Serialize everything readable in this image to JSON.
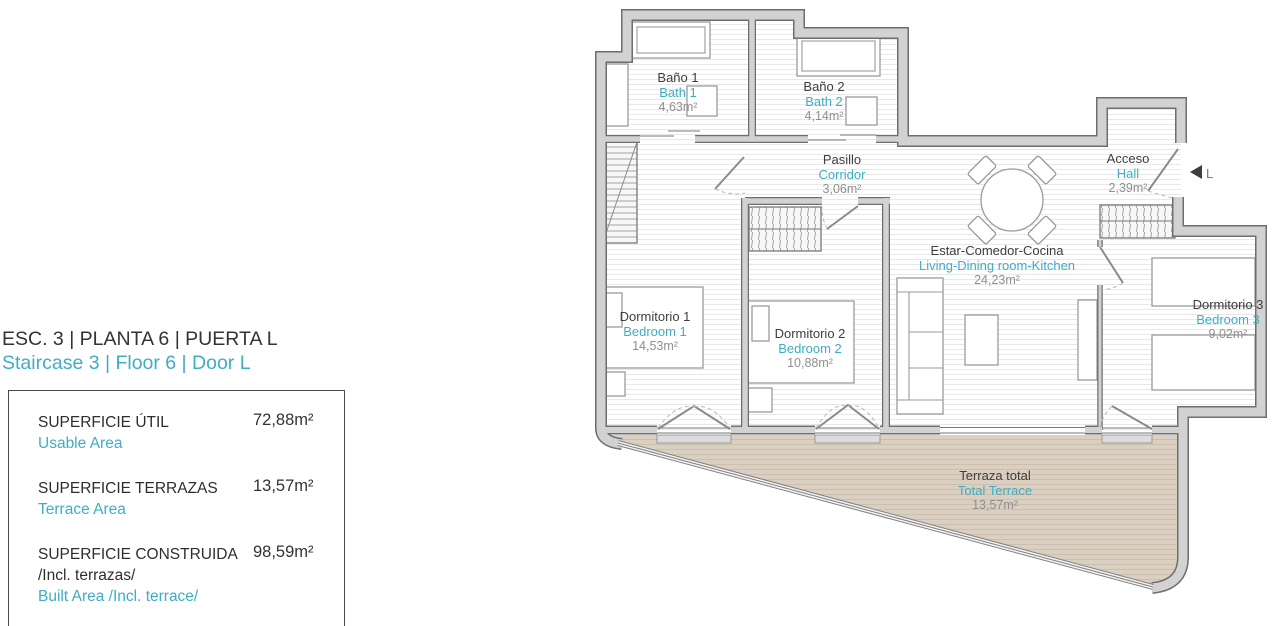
{
  "panel": {
    "title": "ESC. 3 | PLANTA 6 | PUERTA L",
    "subtitle": "Staircase 3 | Floor 6 | Door L",
    "rows": [
      {
        "label_es": "SUPERFICIE ÚTIL",
        "label_en": "Usable Area",
        "value": "72,88m²"
      },
      {
        "label_es": "SUPERFICIE TERRAZAS",
        "label_en": "Terrace Area",
        "value": "13,57m²"
      },
      {
        "label_es": "SUPERFICIE CONSTRUIDA",
        "label_es2": "/Incl. terrazas/",
        "label_en": "Built Area /Incl. terrace/",
        "value": "98,59m²"
      }
    ]
  },
  "plan": {
    "rooms": [
      {
        "name_es": "Baño 1",
        "name_en": "Bath 1",
        "area": "4,63m²"
      },
      {
        "name_es": "Baño 2",
        "name_en": "Bath 2",
        "area": "4,14m²"
      },
      {
        "name_es": "Pasillo",
        "name_en": "Corridor",
        "area": "3,06m²"
      },
      {
        "name_es": "Acceso",
        "name_en": "Hall",
        "area": "2,39m²"
      },
      {
        "name_es": "Estar-Comedor-Cocina",
        "name_en": "Living-Dining room-Kitchen",
        "area": "24,23m²"
      },
      {
        "name_es": "Dormitorio 1",
        "name_en": "Bedroom 1",
        "area": "14,53m²"
      },
      {
        "name_es": "Dormitorio 2",
        "name_en": "Bedroom 2",
        "area": "10,88m²"
      },
      {
        "name_es": "Dormitorio 3",
        "name_en": "Bedroom 3",
        "area": "9,02m²"
      },
      {
        "name_es": "Terraza total",
        "name_en": "Total Terrace",
        "area": "13,57m²"
      }
    ],
    "entrance_label": "L"
  },
  "colors": {
    "accent": "#3fadc4",
    "text_dark": "#3e3e3e",
    "text_muted": "#8f8f8f",
    "wall_fill": "#d2d2d2",
    "wall_edge": "#6e6e6e",
    "terrace_fill": "#dacfc0"
  }
}
